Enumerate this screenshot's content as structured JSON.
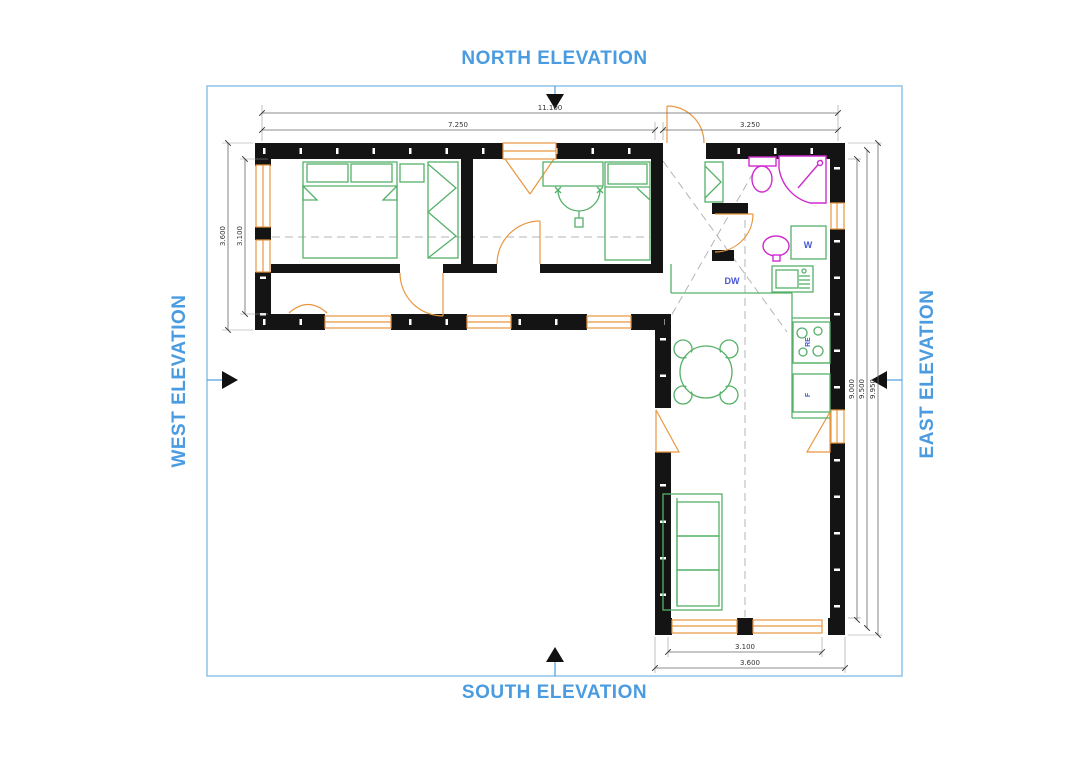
{
  "colors": {
    "accent_blue": "#4a9be0",
    "border_blue": "#8ec4ea",
    "wall_black": "#141414",
    "furniture_green": "#55b169",
    "fixture_magenta": "#cf2bcf",
    "door_window_orange": "#e8973f",
    "appliance_label_blue": "#4656d4"
  },
  "elevation_labels": {
    "north": "NORTH ELEVATION",
    "south": "SOUTH ELEVATION",
    "west": "WEST ELEVATION",
    "east": "EAST ELEVATION"
  },
  "dimensions": {
    "top_overall": "11.100",
    "top_left_wing": "7.250",
    "top_right_wing": "3.250",
    "west_outer": "3.600",
    "west_inner": "3.100",
    "east_inner": "9.000",
    "east_middle": "9.500",
    "east_outer": "9.950",
    "south_inner": "3.100",
    "south_outer": "3.600"
  },
  "appliance_labels": {
    "washer": "W",
    "dishwasher": "DW",
    "range": "RE",
    "fridge": "F"
  }
}
